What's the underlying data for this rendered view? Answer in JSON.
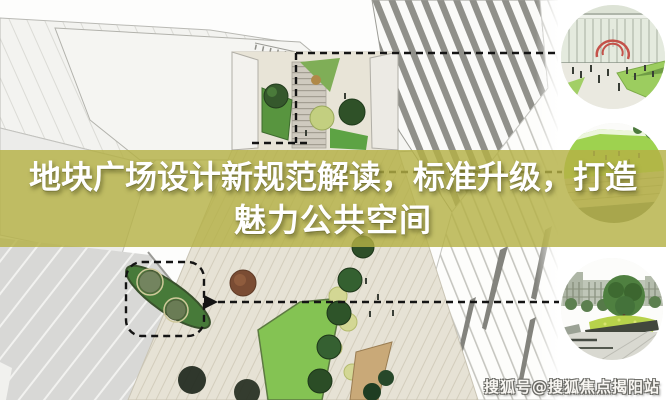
{
  "title": {
    "line1": "地块广场设计新规范解读，标准升级，打造",
    "line2": "魅力公共空间"
  },
  "watermark": {
    "text": "搜狐号@搜狐焦点揭阳站"
  },
  "colors": {
    "band": "rgba(180,177,70,0.82)",
    "title_text": "#ffffff",
    "watermark_text": "#f8f6f2",
    "callout": "#141414",
    "sculpture_red": "#c4524a",
    "lawn_green": "#84c353",
    "dark_bed_green": "#477a39",
    "paving_beige": "#e6e2d5",
    "sketch_gray": "#90908a"
  }
}
